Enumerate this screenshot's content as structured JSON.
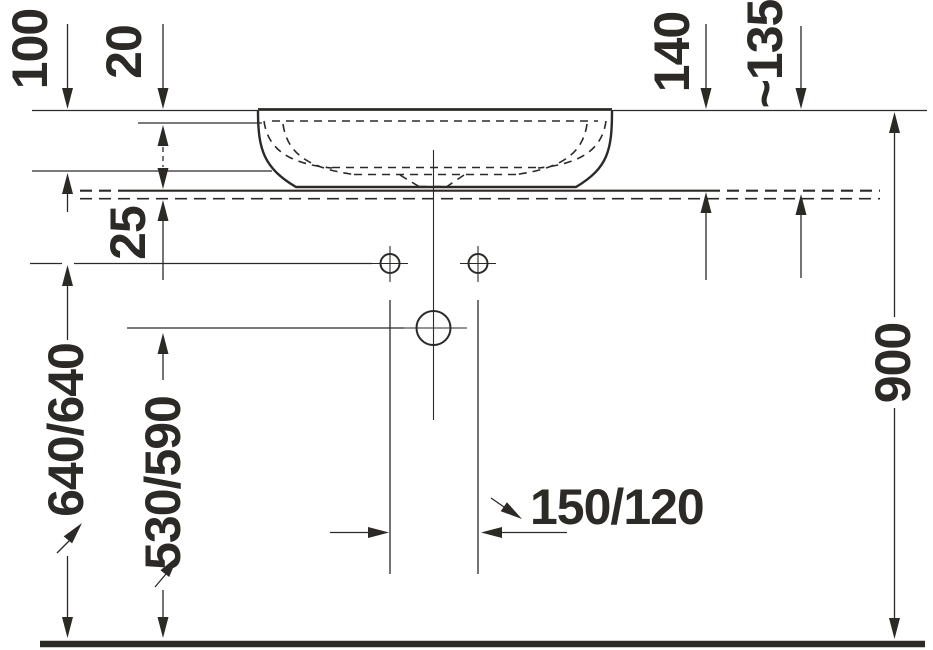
{
  "colors": {
    "background": "#ffffff",
    "ink": "#2c2a27"
  },
  "dimensions": {
    "d100": "100",
    "d20": "20",
    "d25": "25",
    "d640": "640/640",
    "d530": "530/590",
    "d140": "140",
    "d135": "~135",
    "d900": "900",
    "d150": "150/120"
  }
}
